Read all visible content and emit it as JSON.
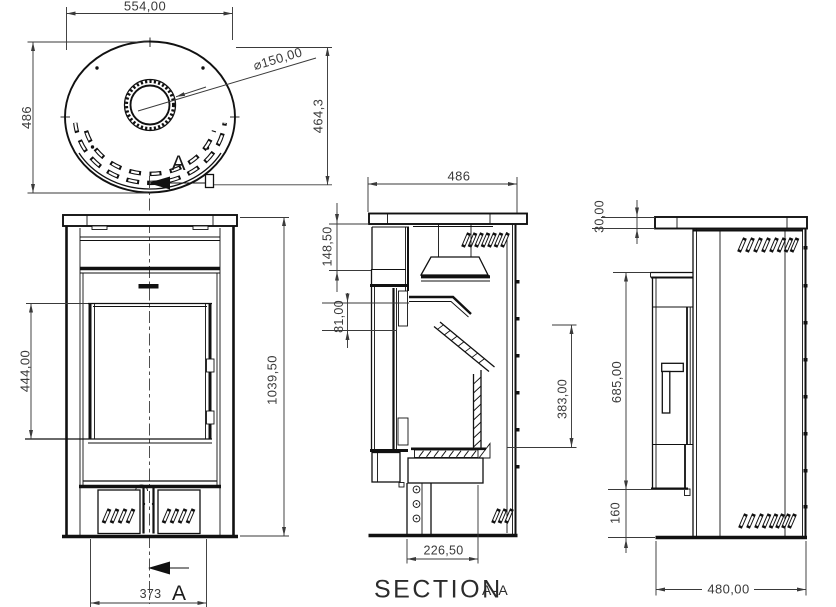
{
  "drawing": {
    "background": "#ffffff",
    "line_color": "#111111",
    "dim_color": "#3a3a3a",
    "top_view": {
      "dim_width": "554,00",
      "dim_depth": "486",
      "dim_flue_diameter": "⌀150,00",
      "dim_flue_offset": "464,3",
      "cut_label": "A"
    },
    "front_view": {
      "dim_glass_height": "444,00",
      "dim_overall_height": "1039,50",
      "dim_door_width": "373",
      "cut_label": "A"
    },
    "section_view": {
      "title": "SECTION",
      "title_suffix": "A-A",
      "dim_top_width": "486",
      "dim_top_depth": "148,50",
      "dim_baffle_drop": "81,00",
      "dim_firebox_height": "383,00",
      "dim_base_depth": "226,50"
    },
    "side_view": {
      "dim_top_thickness": "30,00",
      "dim_door_height": "685,00",
      "dim_plinth_height": "160",
      "dim_overall_depth": "480,00"
    }
  }
}
